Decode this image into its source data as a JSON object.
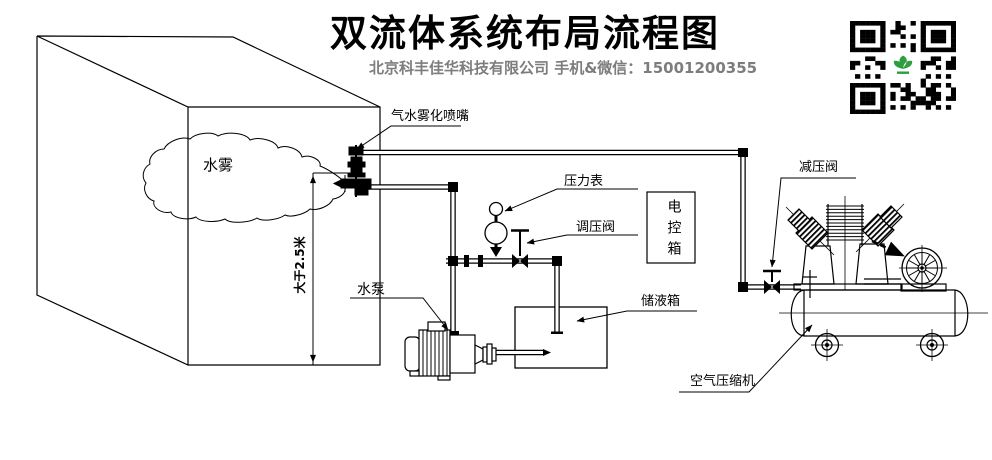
{
  "header": {
    "title": "双流体系统布局流程图",
    "subtitle": "北京科丰佳华科技有限公司 手机&微信：15001200355"
  },
  "labels": {
    "mist": "水雾",
    "nozzle": "气水雾化喷嘴",
    "pressure_gauge": "压力表",
    "regulating_valve": "调压阀",
    "control_box": "电控箱",
    "reducing_valve": "减压阀",
    "water_pump": "水泵",
    "liquid_tank": "储液箱",
    "air_compressor": "空气压缩机",
    "min_height": "大于2.5米"
  },
  "colors": {
    "line": "#000000",
    "subtitle_gray": "#7d7d7d",
    "qr_green": "#2e9e41",
    "background": "#ffffff"
  }
}
